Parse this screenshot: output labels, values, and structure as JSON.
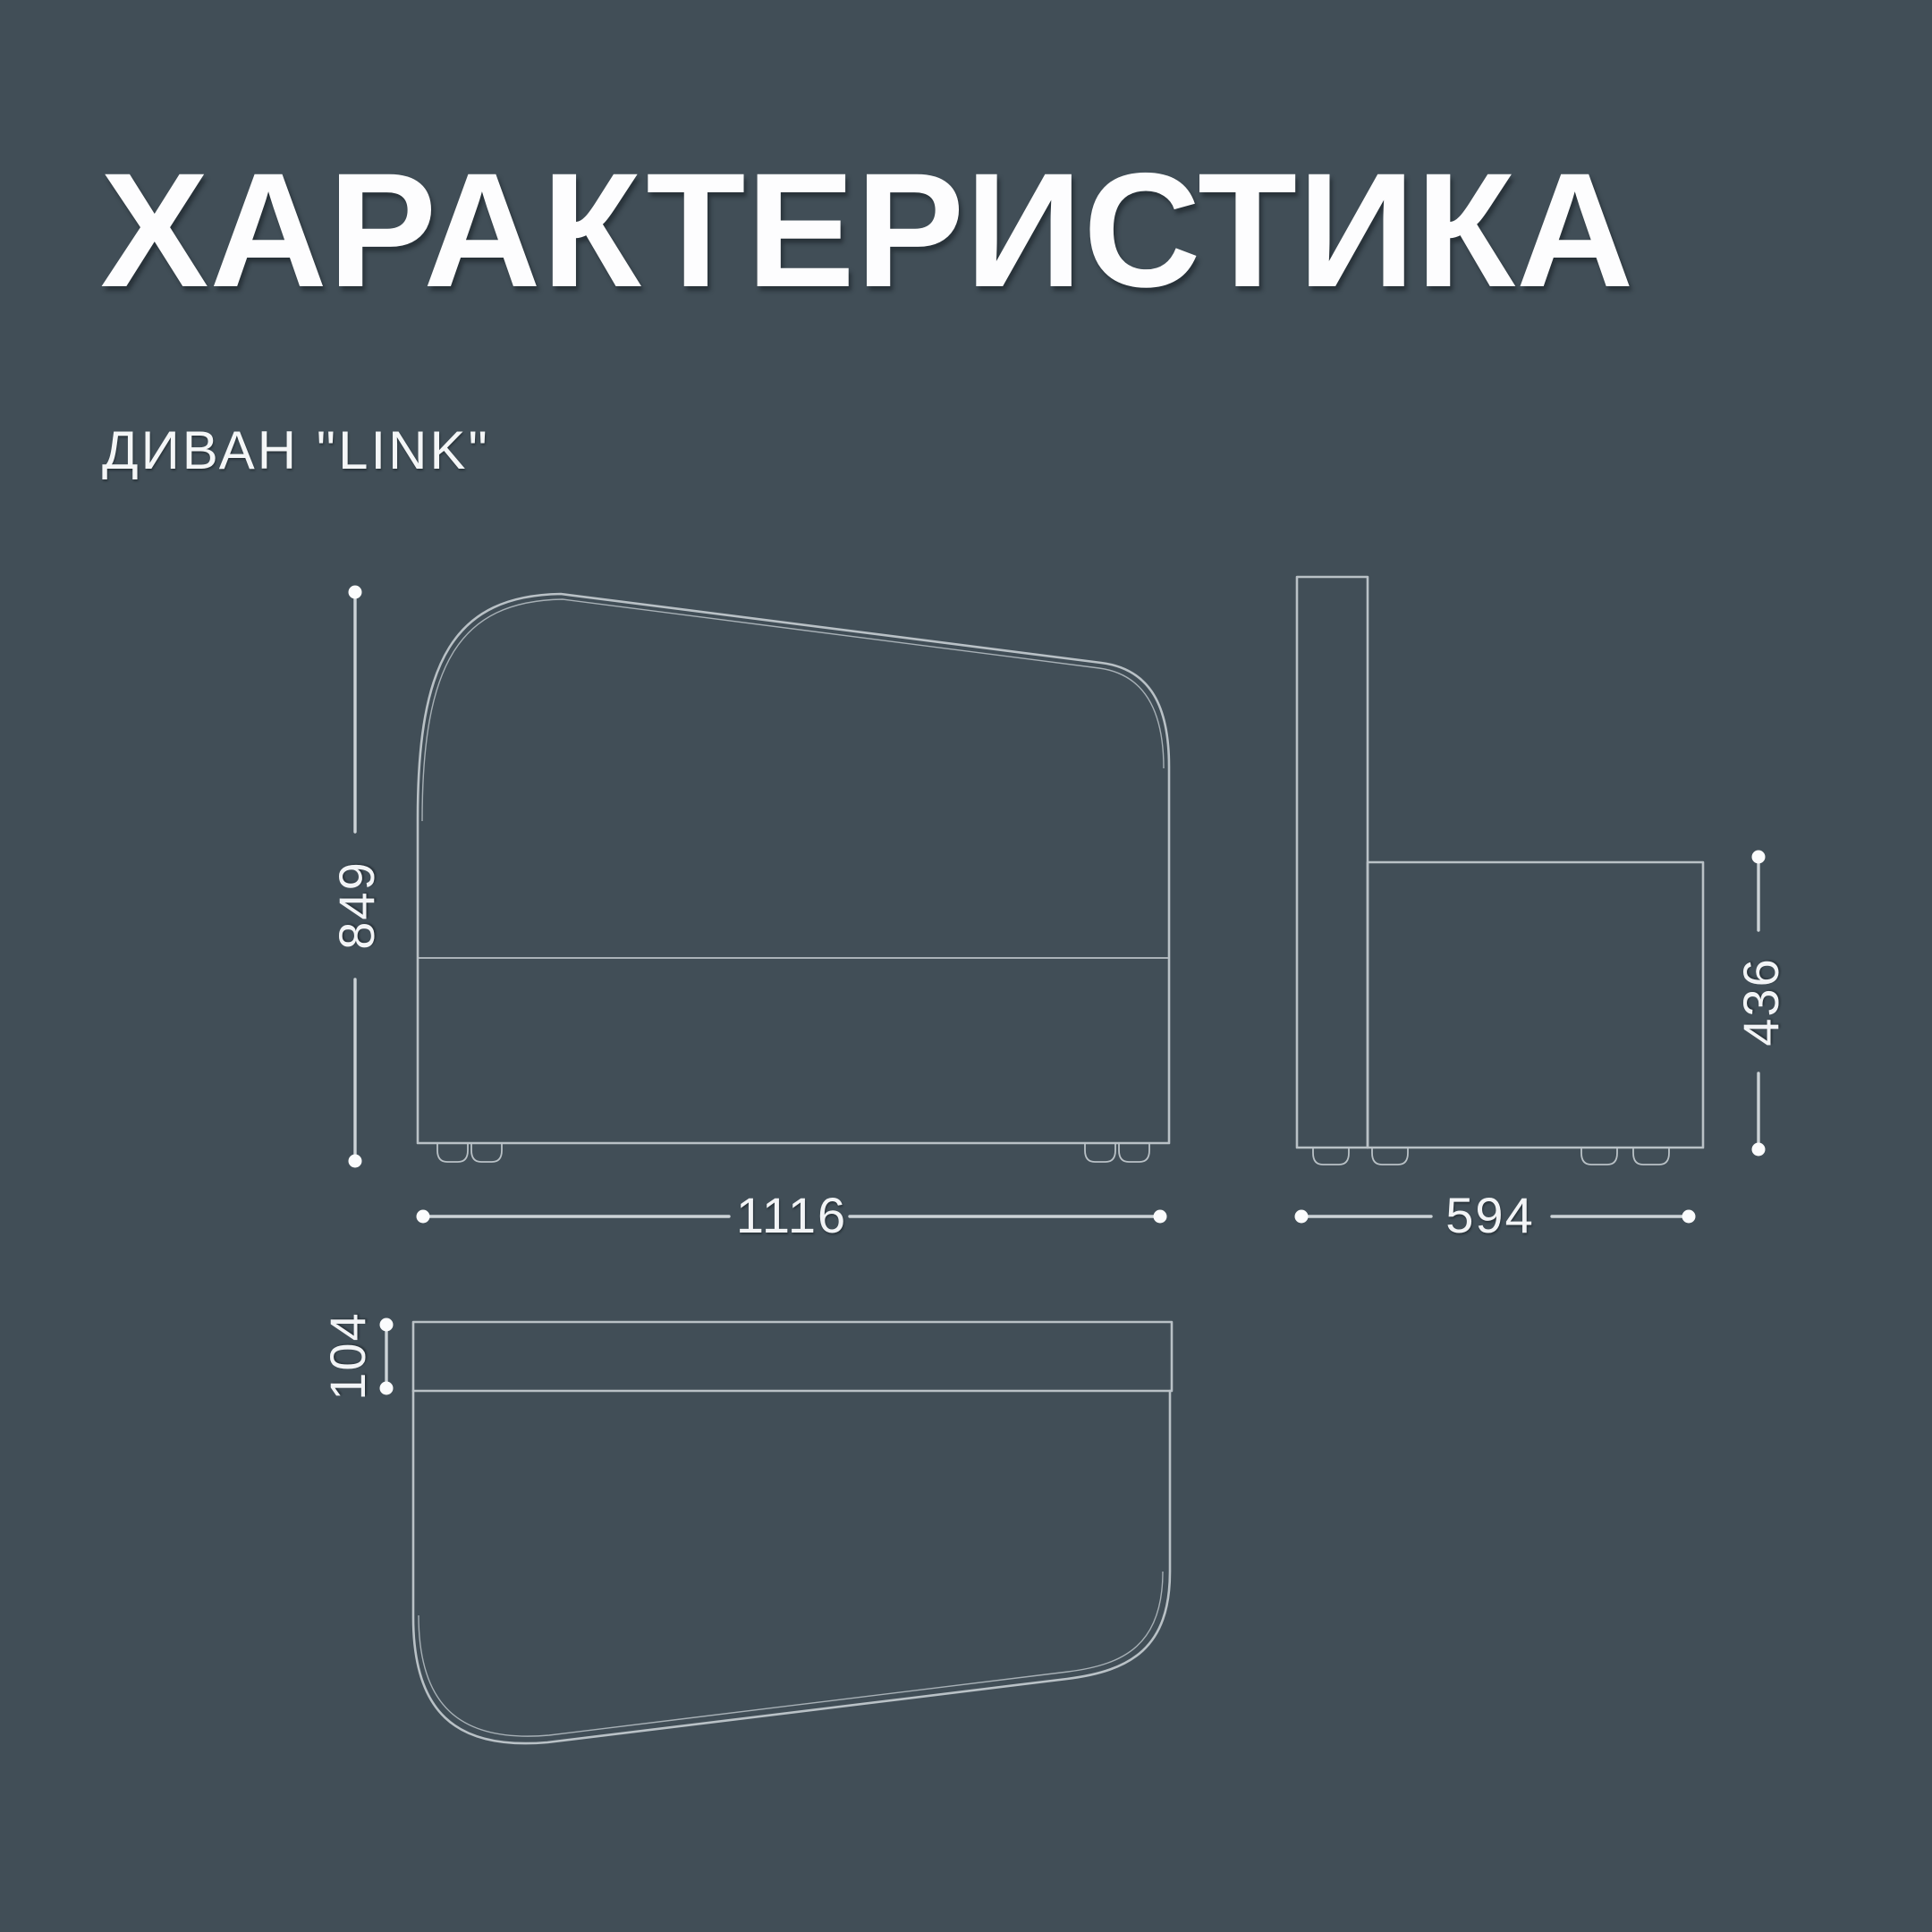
{
  "title": "ХАРАКТЕРИСТИКА",
  "product": {
    "label": "ДИВАН \"LINK\""
  },
  "dimensions_mm": {
    "height": "849",
    "width": "1116",
    "depth": "594",
    "seat_height": "436",
    "backrest_depth": "104"
  },
  "views": {
    "front": "front-view",
    "side": "side-view",
    "top": "top-view"
  },
  "colors": {
    "background": "#414e57",
    "outline": "#b9c1c6",
    "dimension_line": "#ccd3d7",
    "text": "#f4f6f7"
  }
}
